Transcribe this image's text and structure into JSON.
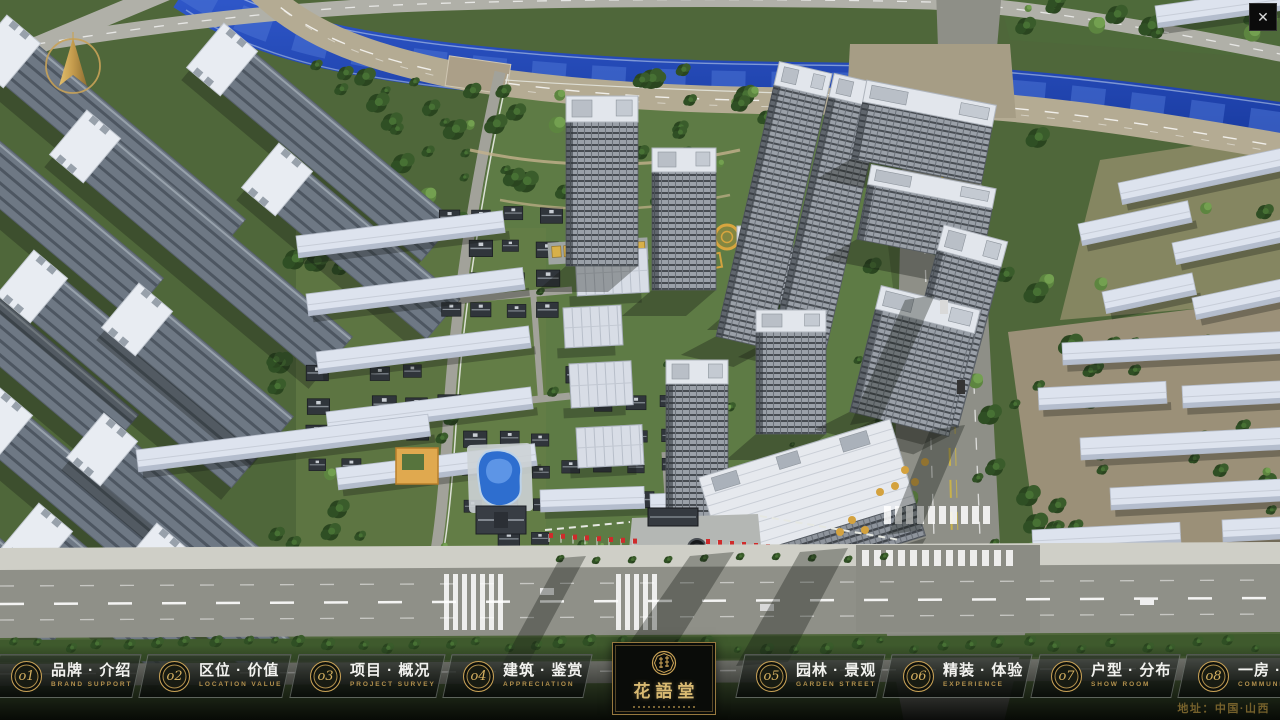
{
  "window": {
    "close_glyph": "✕"
  },
  "brand": {
    "name": "花語堂"
  },
  "menu": {
    "items": [
      {
        "num": "o1",
        "zh": "品牌 · 介绍",
        "en": "BRAND SUPPORT"
      },
      {
        "num": "o2",
        "zh": "区位 · 价值",
        "en": "LOCATION VALUE"
      },
      {
        "num": "o3",
        "zh": "项目 · 概况",
        "en": "PROJECT SURVEY"
      },
      {
        "num": "o4",
        "zh": "建筑 · 鉴赏",
        "en": "APPRECIATION"
      },
      {
        "num": "o5",
        "zh": "园林 · 景观",
        "en": "GARDEN STREET"
      },
      {
        "num": "o6",
        "zh": "精装 · 体验",
        "en": "EXPERIENCE"
      },
      {
        "num": "o7",
        "zh": "户型 · 分布",
        "en": "SHOW ROOM"
      },
      {
        "num": "o8",
        "zh": "一房 · 一景",
        "en": "COMMUNITY"
      }
    ]
  },
  "footer": {
    "address": "地址：中国·山西"
  },
  "colors": {
    "gold": "#c9a256",
    "gold_dim": "#b3914d",
    "river": "#2a55c8"
  }
}
